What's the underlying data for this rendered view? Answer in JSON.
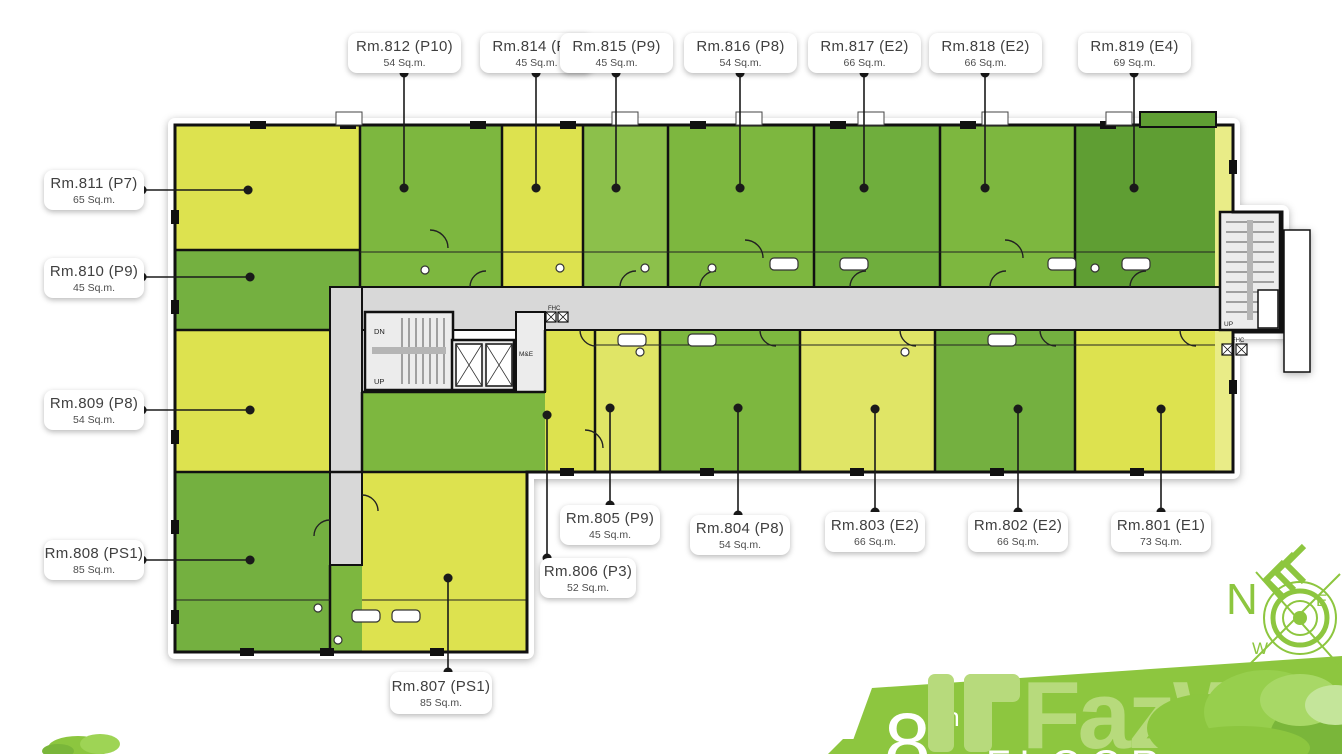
{
  "callouts": [
    {
      "name": "Rm.812 (P10)",
      "area": "54 Sq.m."
    },
    {
      "name": "Rm.814 (P9)",
      "area": "45 Sq.m."
    },
    {
      "name": "Rm.815 (P9)",
      "area": "45 Sq.m."
    },
    {
      "name": "Rm.816 (P8)",
      "area": "54 Sq.m."
    },
    {
      "name": "Rm.817 (E2)",
      "area": "66 Sq.m."
    },
    {
      "name": "Rm.818 (E2)",
      "area": "66 Sq.m."
    },
    {
      "name": "Rm.819 (E4)",
      "area": "69 Sq.m."
    },
    {
      "name": "Rm.811 (P7)",
      "area": "65 Sq.m."
    },
    {
      "name": "Rm.810 (P9)",
      "area": "45 Sq.m."
    },
    {
      "name": "Rm.809 (P8)",
      "area": "54 Sq.m."
    },
    {
      "name": "Rm.808 (PS1)",
      "area": "85 Sq.m."
    },
    {
      "name": "Rm.807 (PS1)",
      "area": "85 Sq.m."
    },
    {
      "name": "Rm.806 (P3)",
      "area": "52 Sq.m."
    },
    {
      "name": "Rm.805 (P9)",
      "area": "45 Sq.m."
    },
    {
      "name": "Rm.804 (P8)",
      "area": "54 Sq.m."
    },
    {
      "name": "Rm.803 (E2)",
      "area": "66 Sq.m."
    },
    {
      "name": "Rm.802 (E2)",
      "area": "66 Sq.m."
    },
    {
      "name": "Rm.801 (E1)",
      "area": "73 Sq.m."
    }
  ],
  "plan_labels": {
    "dn": "DN",
    "up": "UP",
    "me": "M&E",
    "fhc": "FHC"
  },
  "compass": {
    "north": "N",
    "east": "E",
    "west": "W"
  },
  "footer": {
    "floor_number": "8",
    "floor_ordinal": "th",
    "caption": "FLOOR PLAN",
    "brand": "FazWaz"
  },
  "colors": {
    "banner_green": "#8dc63f",
    "room_yellow": "#dde24f",
    "room_green": "#7db73f",
    "room_green_dark": "#6fae3d",
    "corridor_gray": "#d8d8d8",
    "watermark_green": "#b7da7c"
  }
}
